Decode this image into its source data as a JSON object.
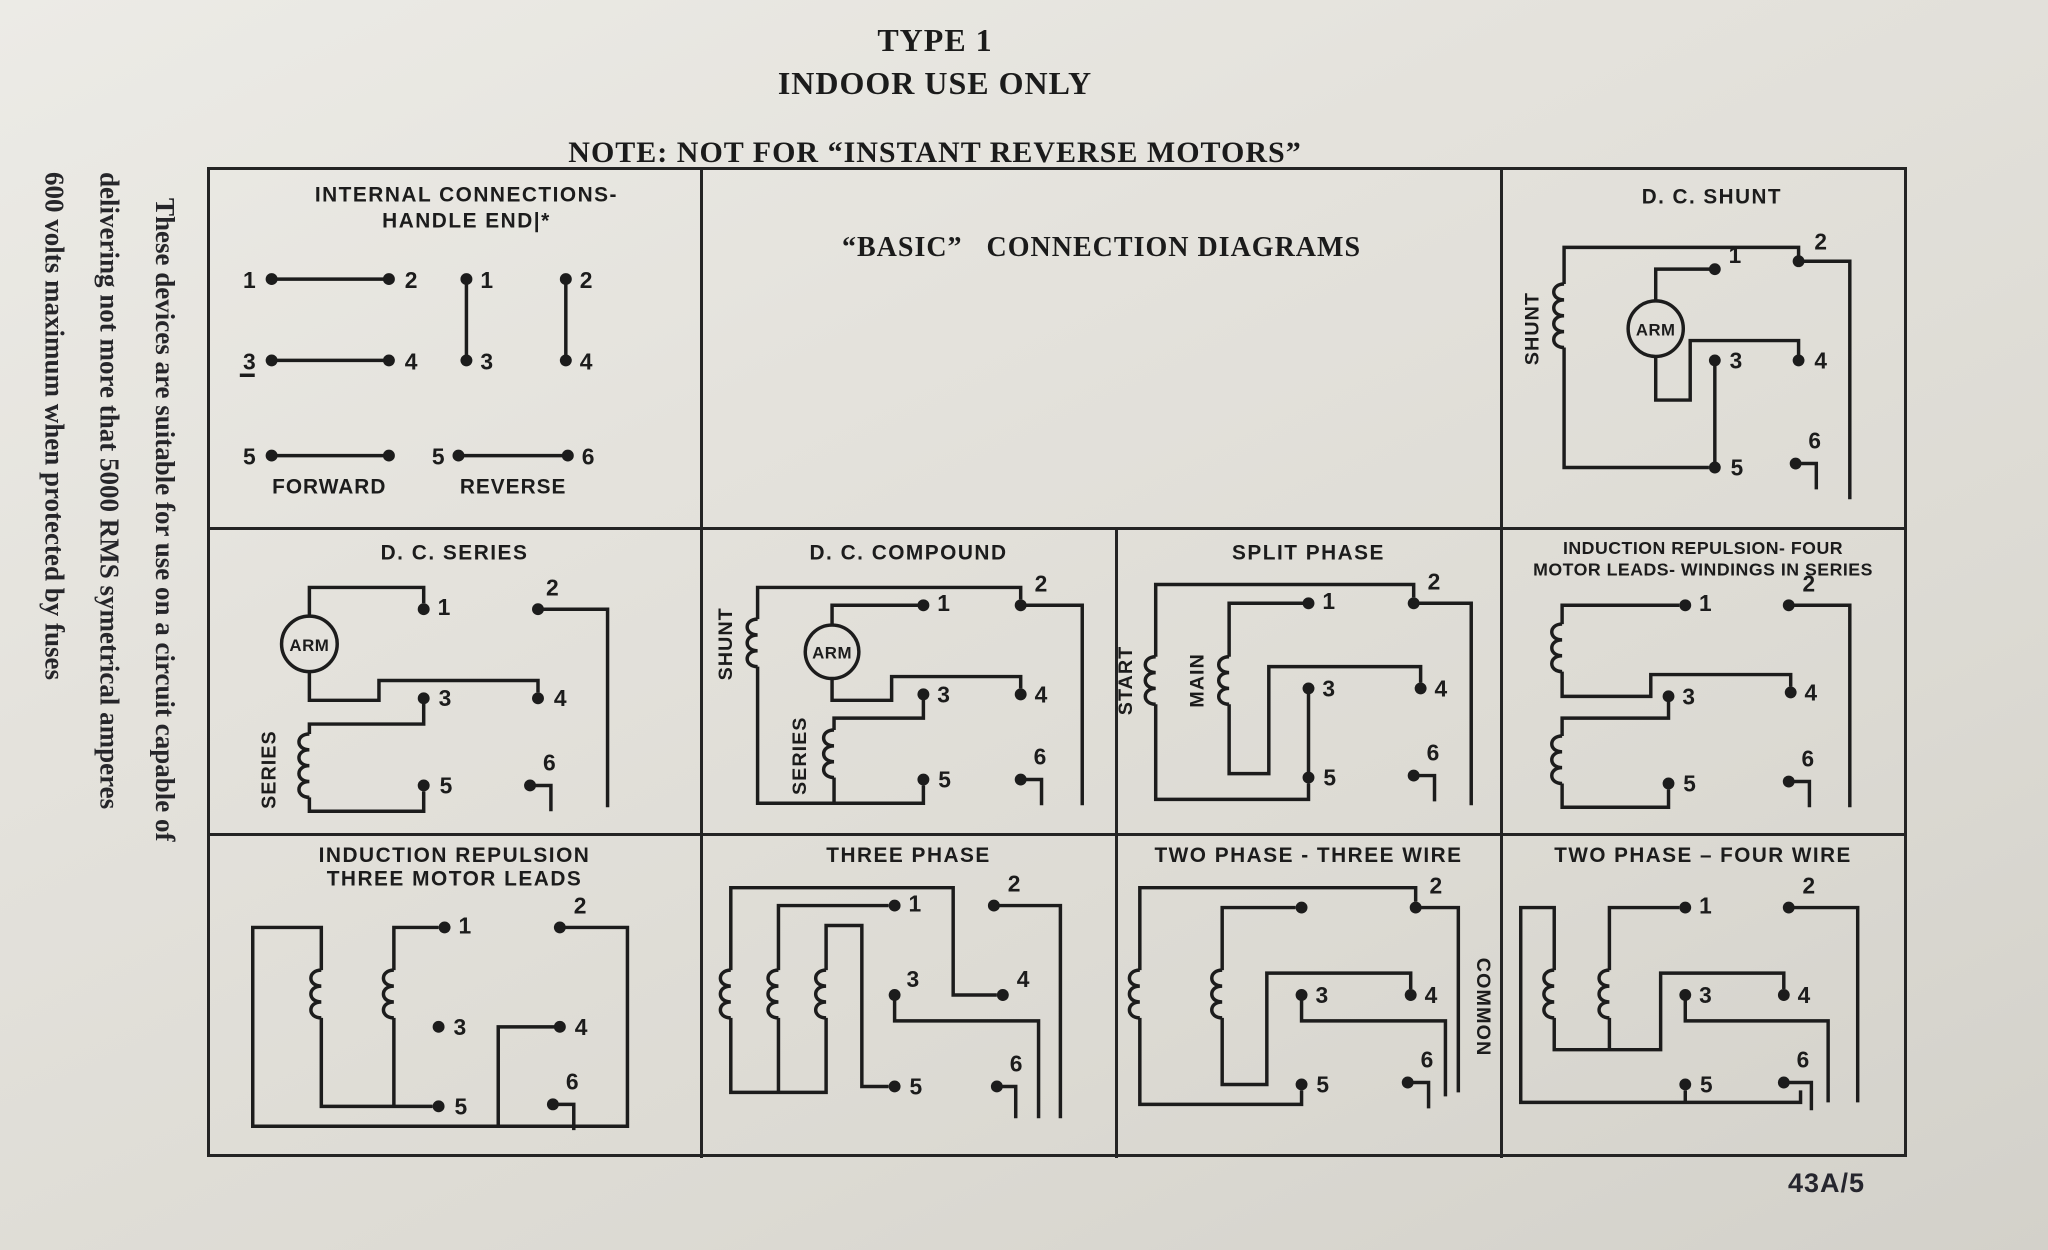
{
  "page": {
    "title_line1": "TYPE 1",
    "title_line2": "INDOOR USE ONLY",
    "note": "NOTE:  NOT FOR  “INSTANT REVERSE MOTORS”",
    "side_note_lines": [
      "These devices are suitable for use on a circuit capable of",
      "delivering not more that 5000 RMS symetrical amperes",
      "600 volts maximum when protected by fuses"
    ],
    "doc_number": "43A/5"
  },
  "cells": {
    "internal": {
      "title1": "INTERNAL  CONNECTIONS-",
      "title2": "HANDLE  END|*",
      "forward_label": "FORWARD",
      "reverse_label": "REVERSE",
      "f": {
        "n1": "1",
        "n2": "2",
        "n3": "3",
        "n4": "4",
        "n5": "5"
      },
      "r": {
        "n1": "1",
        "n2": "2",
        "n3": "3",
        "n4": "4",
        "n5": "5",
        "n6": "6"
      }
    },
    "basic": {
      "title": "“BASIC”   CONNECTION DIAGRAMS"
    },
    "dc_shunt": {
      "title": "D. C.  SHUNT",
      "coil_label": "SHUNT",
      "arm_label": "ARM",
      "t": {
        "n1": "1",
        "n2": "2",
        "n3": "3",
        "n4": "4",
        "n5": "5",
        "n6": "6"
      }
    },
    "dc_series": {
      "title": "D. C.  SERIES",
      "coil_label": "SERIES",
      "arm_label": "ARM",
      "t": {
        "n1": "1",
        "n2": "2",
        "n3": "3",
        "n4": "4",
        "n5": "5",
        "n6": "6"
      }
    },
    "dc_compound": {
      "title": "D. C.  COMPOUND",
      "shunt_label": "SHUNT",
      "series_label": "SERIES",
      "arm_label": "ARM",
      "t": {
        "n1": "1",
        "n2": "2",
        "n3": "3",
        "n4": "4",
        "n5": "5",
        "n6": "6"
      }
    },
    "split_phase": {
      "title": "SPLIT   PHASE",
      "start_label": "START",
      "main_label": "MAIN",
      "t": {
        "n1": "1",
        "n2": "2",
        "n3": "3",
        "n4": "4",
        "n5": "5",
        "n6": "6"
      }
    },
    "ind_rep_four": {
      "title1": "INDUCTION REPULSION- FOUR",
      "title2": "MOTOR LEADS- WINDINGS IN SERIES",
      "t": {
        "n1": "1",
        "n2": "2",
        "n3": "3",
        "n4": "4",
        "n5": "5",
        "n6": "6"
      }
    },
    "ind_rep_three": {
      "title1": "INDUCTION REPULSION",
      "title2": "THREE MOTOR LEADS",
      "t": {
        "n1": "1",
        "n2": "2",
        "n3": "3",
        "n4": "4",
        "n5": "5",
        "n6": "6"
      }
    },
    "three_phase": {
      "title": "THREE  PHASE",
      "t": {
        "n1": "1",
        "n2": "2",
        "n3": "3",
        "n4": "4",
        "n5": "5",
        "n6": "6"
      }
    },
    "two_phase_three_wire": {
      "title": "TWO PHASE -  THREE WIRE",
      "common_label": "COMMON",
      "t": {
        "n1": "",
        "n2": "2",
        "n3": "3",
        "n4": "4",
        "n5": "5",
        "n6": "6"
      }
    },
    "two_phase_four_wire": {
      "title": "TWO  PHASE – FOUR WIRE",
      "t": {
        "n1": "1",
        "n2": "2",
        "n3": "3",
        "n4": "4",
        "n5": "5",
        "n6": "6"
      }
    }
  }
}
